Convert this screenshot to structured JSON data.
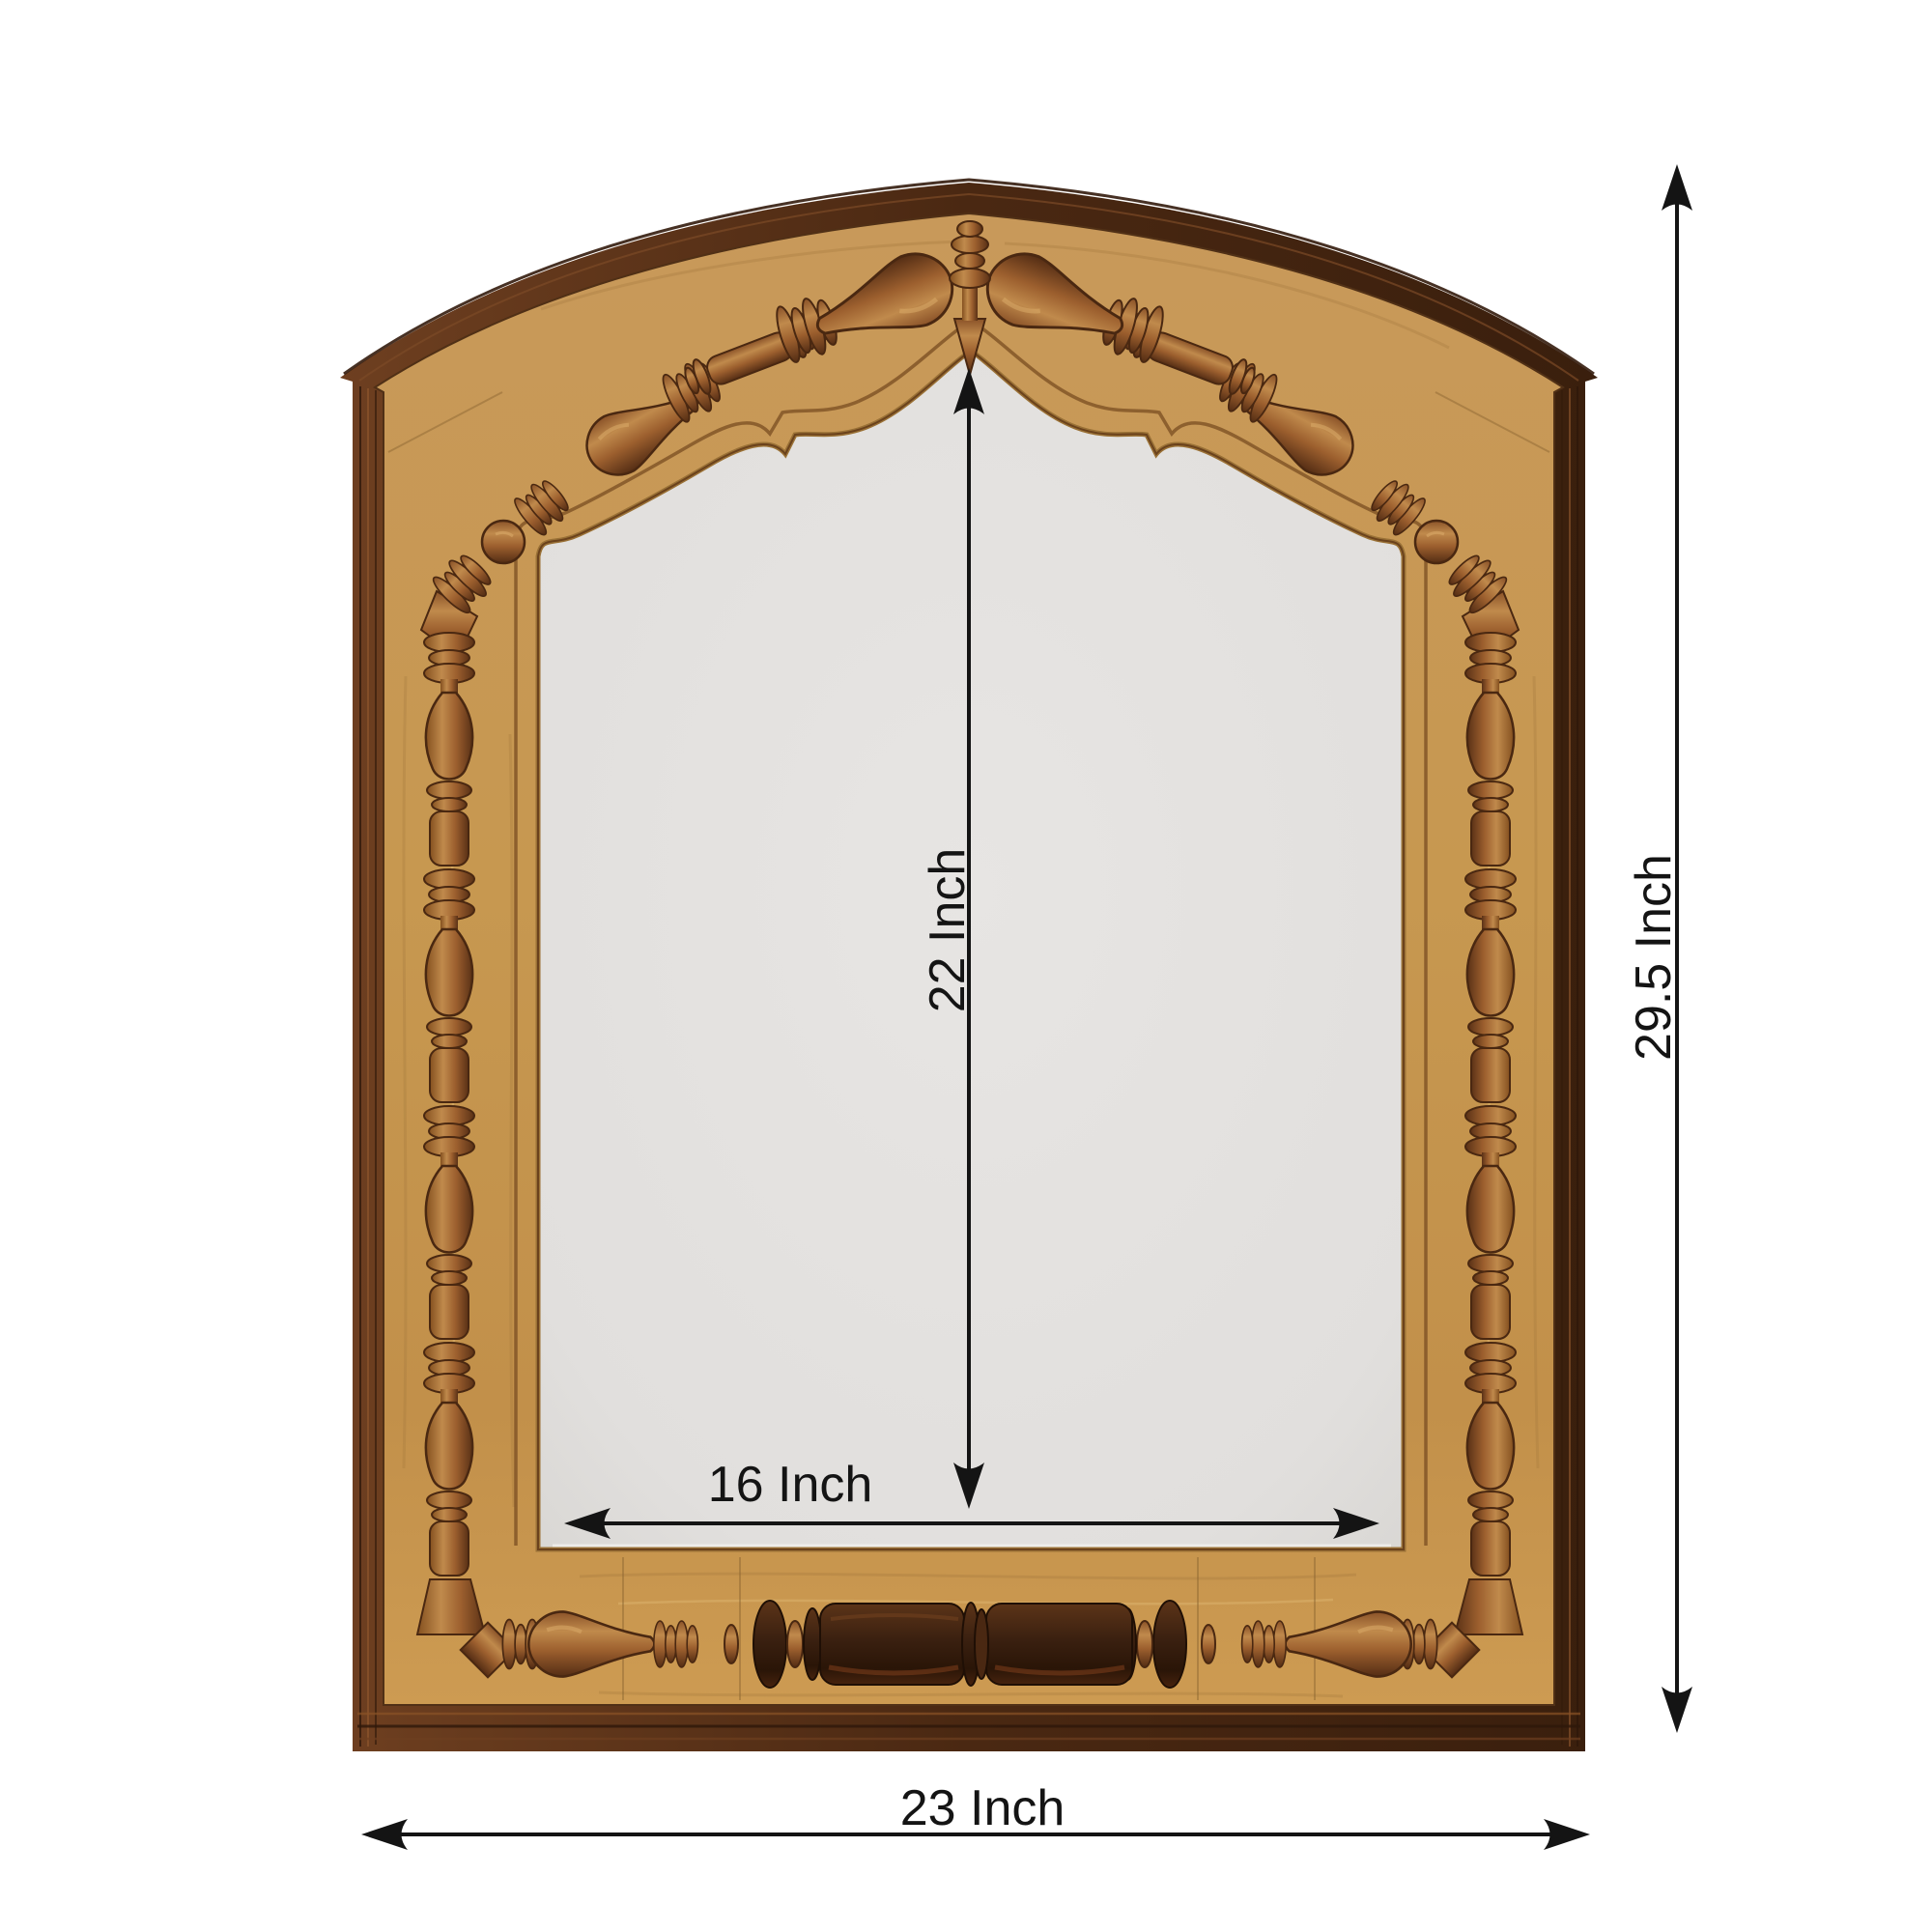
{
  "page": {
    "type": "product-dimension-diagram",
    "background_color": "#ffffff"
  },
  "product": {
    "name": "Carved wooden arched wall mirror frame",
    "style": "arched top with turned spindle carvings",
    "colors": {
      "trim_dark_brown": "#4a2812",
      "wood_tan": "#c79850",
      "spindle_brown": "#9c5f2e",
      "dark_cylinder": "#3a2010",
      "mirror_glass": "#e3e1df"
    }
  },
  "annotations": {
    "color": "#141414",
    "inner_height_label": "22 Inch",
    "inner_width_label": "16 Inch",
    "outer_height_label": "29.5 Inch",
    "outer_width_label": "23 Inch"
  }
}
